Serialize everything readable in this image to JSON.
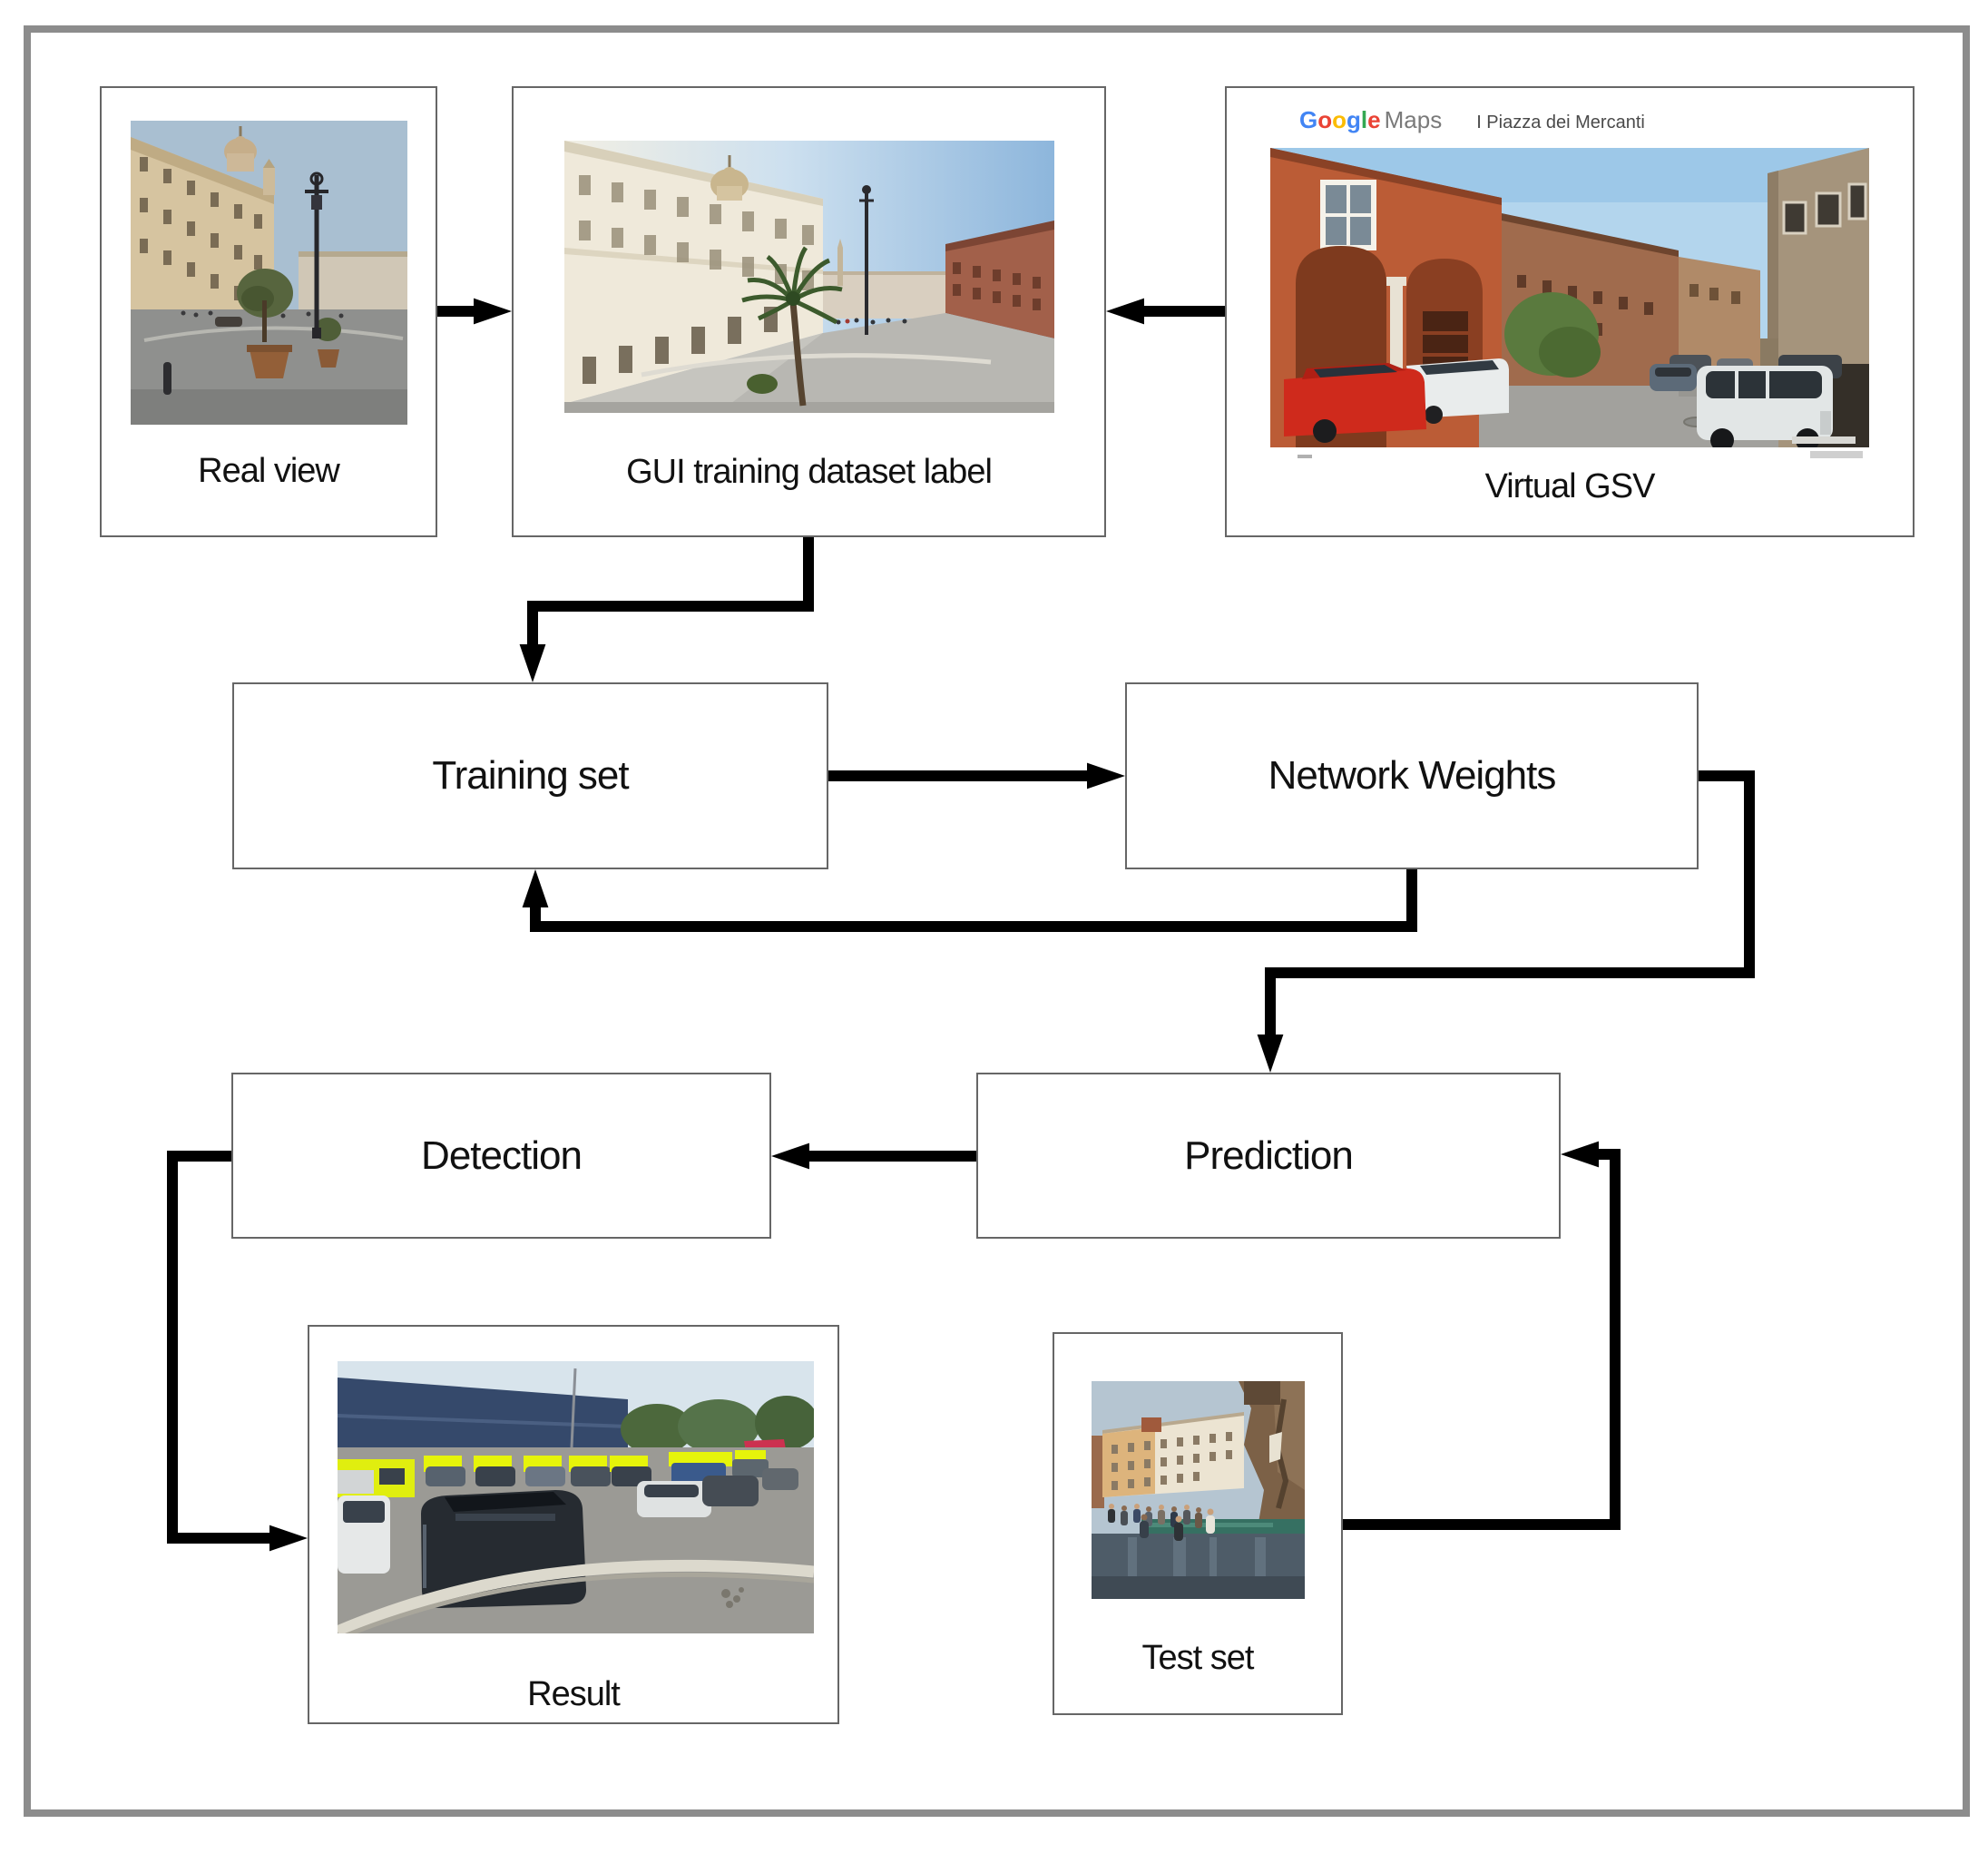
{
  "nodes": {
    "real_view": {
      "label": "Real view"
    },
    "gui_training": {
      "label": "GUI training dataset label"
    },
    "virtual_gsv": {
      "label": "Virtual GSV"
    },
    "training_set": {
      "label": "Training set"
    },
    "network_weights": {
      "label": "Network Weights"
    },
    "prediction": {
      "label": "Prediction"
    },
    "detection": {
      "label": "Detection"
    },
    "result": {
      "label": "Result"
    },
    "test_set": {
      "label": "Test set"
    }
  },
  "gsv_header": {
    "google_letters": [
      "G",
      "o",
      "o",
      "g",
      "l",
      "e"
    ],
    "google_colors": [
      "#4285F4",
      "#EA4335",
      "#FBBC05",
      "#4285F4",
      "#34A853",
      "#EA4335"
    ],
    "maps_label": "Maps",
    "query": "I Piazza dei Mercanti"
  },
  "edges": [
    {
      "from": "real_view",
      "to": "gui_training"
    },
    {
      "from": "virtual_gsv",
      "to": "gui_training"
    },
    {
      "from": "gui_training",
      "to": "training_set"
    },
    {
      "from": "training_set",
      "to": "network_weights"
    },
    {
      "from": "network_weights",
      "to": "training_set"
    },
    {
      "from": "network_weights",
      "to": "prediction"
    },
    {
      "from": "prediction",
      "to": "detection"
    },
    {
      "from": "detection",
      "to": "result"
    },
    {
      "from": "test_set",
      "to": "prediction"
    }
  ],
  "colors": {
    "connector": "#000000",
    "box_border": "#666666",
    "frame_border": "#8c8c8c",
    "label_text": "#111111"
  }
}
